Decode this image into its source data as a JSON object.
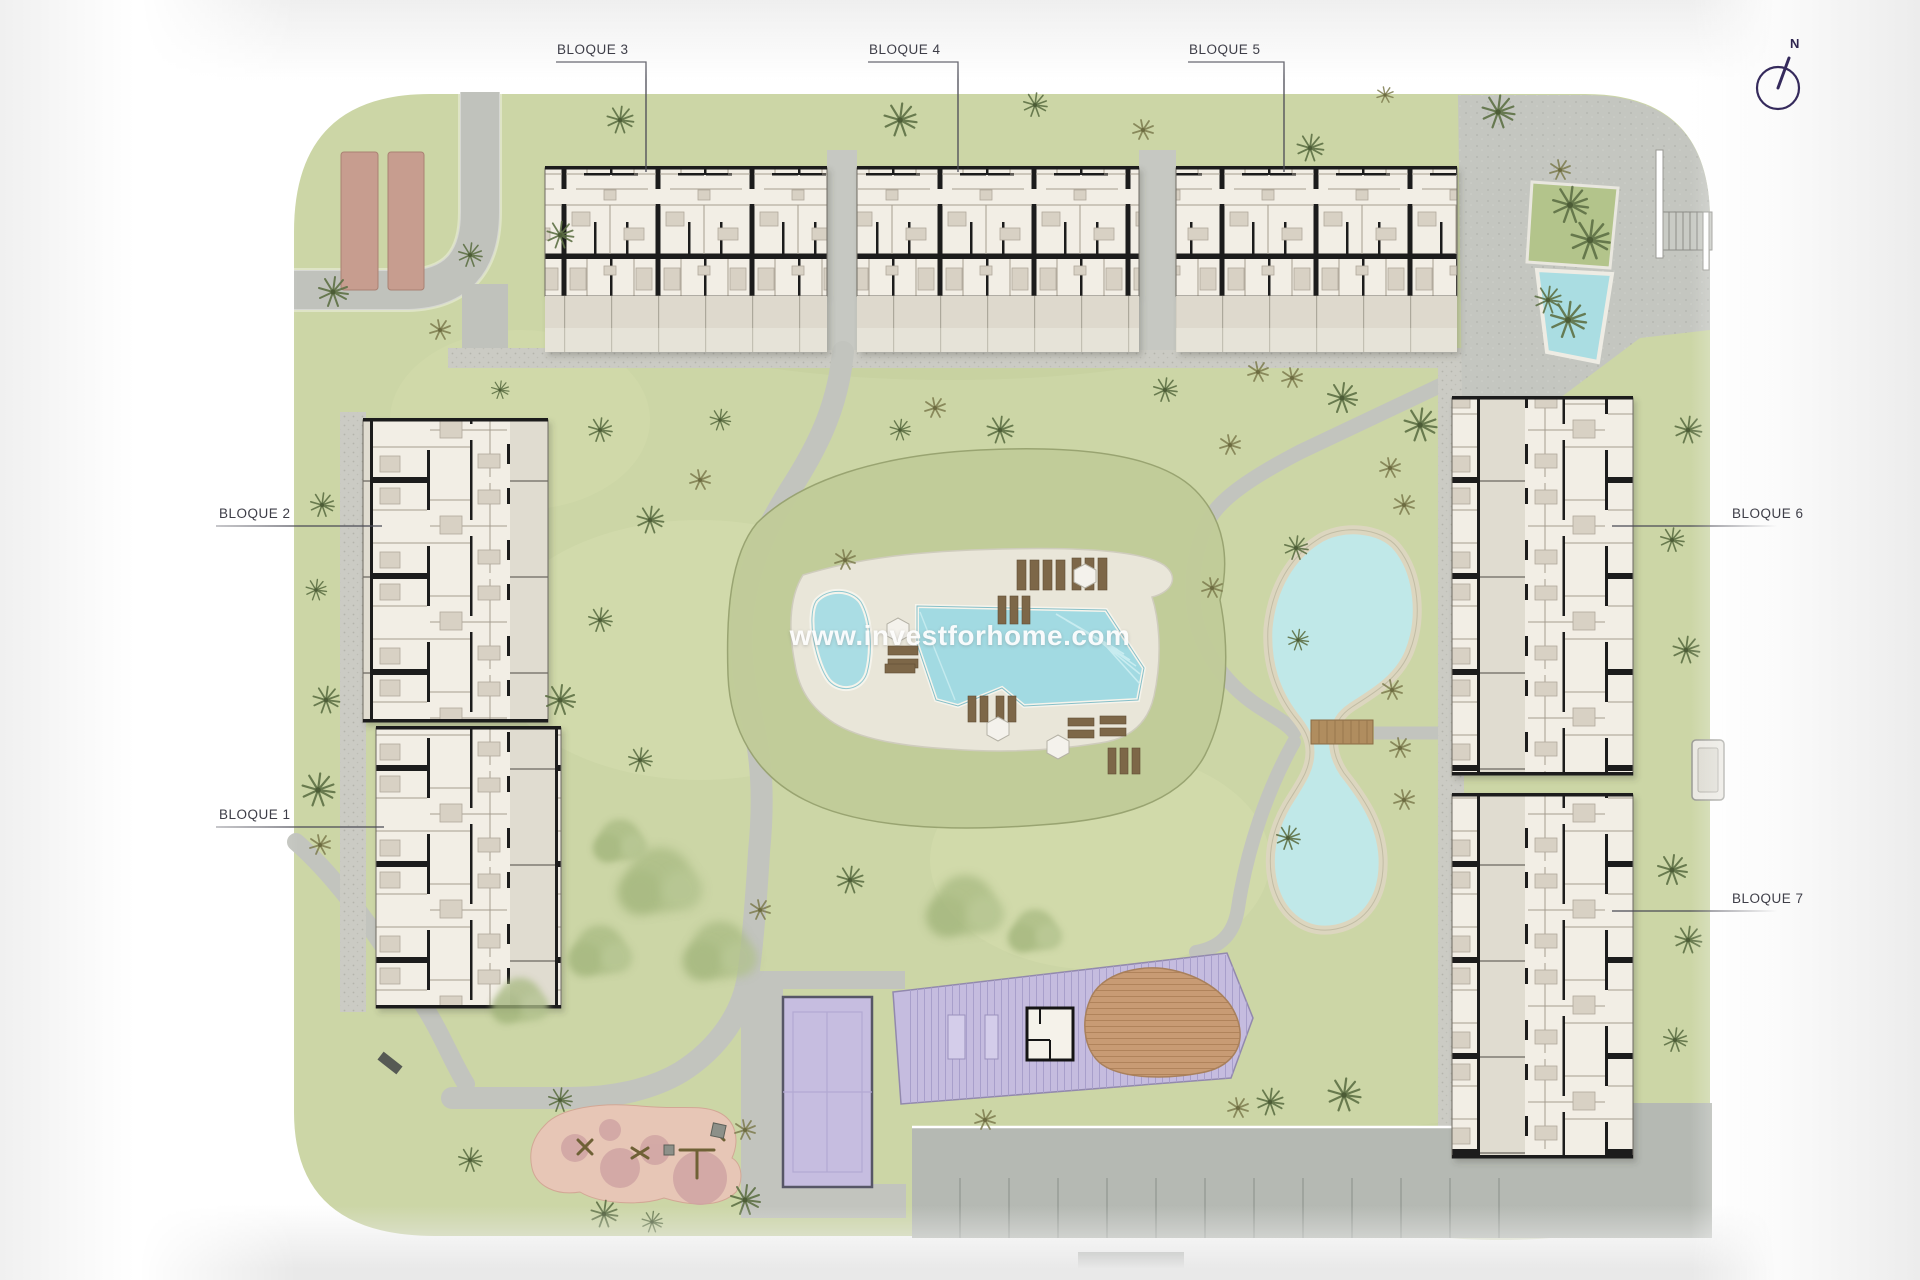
{
  "watermark": {
    "text": "www.investforhome.com"
  },
  "compass": {
    "label": "N"
  },
  "blocks": {
    "b1": {
      "label": "BLOQUE 1"
    },
    "b2": {
      "label": "BLOQUE 2"
    },
    "b3": {
      "label": "BLOQUE 3"
    },
    "b4": {
      "label": "BLOQUE 4"
    },
    "b5": {
      "label": "BLOQUE 5"
    },
    "b6": {
      "label": "BLOQUE 6"
    },
    "b7": {
      "label": "BLOQUE 7"
    }
  },
  "colors": {
    "grass": "#ccd6a6",
    "mound_grass": "#c1cc99",
    "pool_water": "#a9dde4",
    "lake_water": "#c0e8e8",
    "deck": "#e9e6d9",
    "path_gray": "#c2c4be",
    "building_floor": "#f2eee5",
    "wall_black": "#1a1a1a",
    "sport_purple": "#c6bde0",
    "pergola_purple": "#c5bcdf",
    "solarium_brown": "#c89b74",
    "playground_pink": "#e7c6b6",
    "shade_structure": "#c79d8f",
    "label_text": "#3e3e48",
    "compass_ink": "#352a5c"
  }
}
